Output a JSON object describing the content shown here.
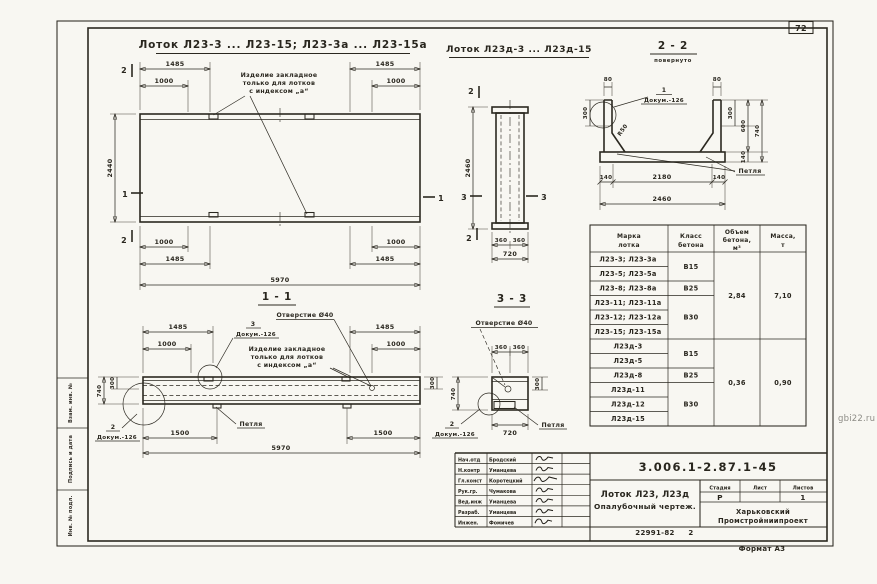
{
  "sheet": {
    "page_number": "72",
    "format_note": "Формат А3",
    "inventory_note": "22991-82",
    "inventory_sheet": "2",
    "watermark": "gbi22.ru",
    "stamp_side": {
      "field1": "Взам. инв. №",
      "field2": "Подпись и дата",
      "field3": "Инв. № подл."
    }
  },
  "views": {
    "plan": {
      "title": "Лоток Л23-3 ... Л23-15; Л23-3а ... Л23-15а"
    },
    "plan_d": {
      "title": "Лоток Л23д-3 ... Л23д-15"
    },
    "s22": {
      "title": "2 - 2",
      "subtitle": "повернуто"
    },
    "s11": {
      "title": "1 - 1"
    },
    "s33": {
      "title": "3 - 3"
    }
  },
  "notes": {
    "embed_line1": "Изделие закладное",
    "embed_line2": "только для лотков",
    "embed_line3": "с индексом „а“",
    "hole": "Отверстие Ø40",
    "petlya": "Петля",
    "radius": "R50",
    "detail1": "1",
    "detail2": "2",
    "detail3": "3",
    "dokum": "Докум.-126"
  },
  "dims": {
    "d80": "80",
    "d140": "140",
    "d300": "300",
    "d360": "360",
    "d600": "600",
    "d720": "720",
    "d740": "740",
    "d1000": "1000",
    "d1485": "1485",
    "d1500": "1500",
    "d2180": "2180",
    "d2440": "2440",
    "d2460": "2460",
    "d5970": "5970"
  },
  "marks": {
    "m1": "1",
    "m2": "2",
    "m3": "3"
  },
  "table": {
    "header_mark_l1": "Марка",
    "header_mark_l2": "лотка",
    "header_class_l1": "Класс",
    "header_class_l2": "бетона",
    "header_vol_l1": "Объем",
    "header_vol_l2": "бетона,",
    "header_vol_l3": "м³",
    "header_mass_l1": "Масса,",
    "header_mass_l2": "т",
    "marks": [
      "Л23-3; Л23-3а",
      "Л23-5; Л23-5а",
      "Л23-8; Л23-8а",
      "Л23-11; Л23-11а",
      "Л23-12; Л23-12а",
      "Л23-15; Л23-15а",
      "Л23д-3",
      "Л23д-5",
      "Л23д-8",
      "Л23д-11",
      "Л23д-12",
      "Л23д-15"
    ],
    "classes": [
      "В15",
      "В25",
      "В30",
      "В15",
      "В25",
      "В30"
    ],
    "volumes": [
      "2,84",
      "0,36"
    ],
    "masses": [
      "7,10",
      "0,90"
    ]
  },
  "title_block": {
    "doc_code": "3.006.1-2.87.1-45",
    "title_line1": "Лоток Л23, Л23д",
    "title_line2": "Опалубочный чертеж.",
    "stage_label": "Стадия",
    "sheet_label": "Лист",
    "sheets_label": "Листов",
    "stage": "Р",
    "sheets_count": "1",
    "org_line1": "Харьковский",
    "org_line2": "Промстройниипроект",
    "signers": [
      {
        "role": "Нач.отд",
        "name": "Бродский"
      },
      {
        "role": "Н.контр",
        "name": "Уманцева"
      },
      {
        "role": "Гл.конст",
        "name": "Коротецкий"
      },
      {
        "role": "Рук.гр.",
        "name": "Чумакова"
      },
      {
        "role": "Вед.инж",
        "name": "Уманцева"
      },
      {
        "role": "Разраб.",
        "name": "Уманцева"
      },
      {
        "role": "Инжен.",
        "name": "Фомичев"
      }
    ]
  }
}
